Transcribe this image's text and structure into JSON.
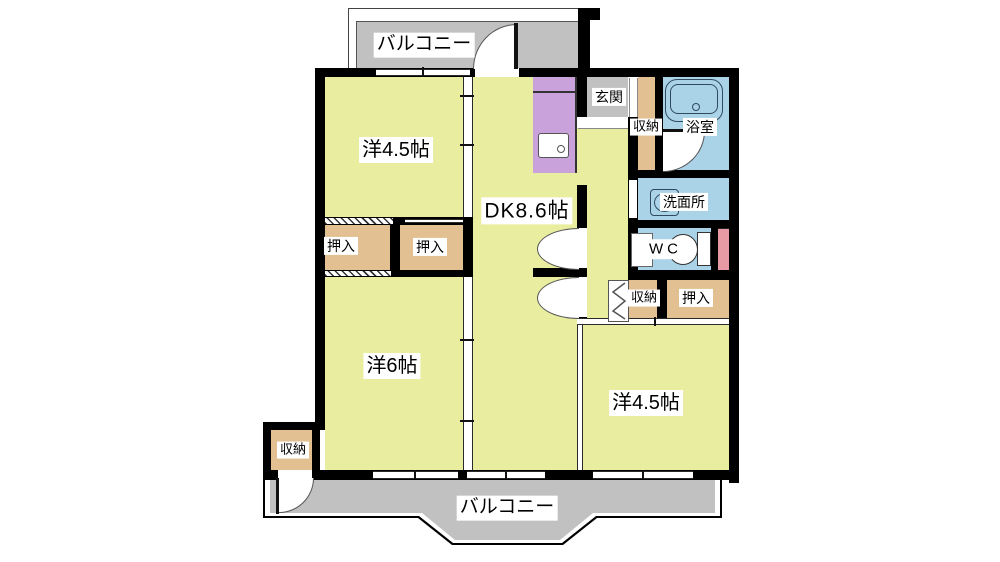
{
  "floorplan": {
    "labels": {
      "balcony_top": "バルコニー",
      "balcony_bottom": "バルコニー",
      "room_west_upper": "洋4.5帖",
      "dining_kitchen": "DK8.6帖",
      "room_west_lower": "洋6帖",
      "room_east": "洋4.5帖",
      "entrance": "玄関",
      "hall_storage": "収納",
      "bathroom": "浴室",
      "washroom": "洗面所",
      "toilet": "WC",
      "mid_storage": "収納",
      "closet_east": "押入",
      "closet_left_1": "押入",
      "closet_left_2": "押入",
      "storage_bottom_left": "収納"
    },
    "colors": {
      "room": "#e8ed9f",
      "closet": "#e2c091",
      "balcony": "#c2c1c1",
      "water": "#abd3e8",
      "kitchen": "#c9a2dc",
      "pink": "#e89aa4",
      "wall": "#000000",
      "label_bg": "#ffffff"
    }
  }
}
